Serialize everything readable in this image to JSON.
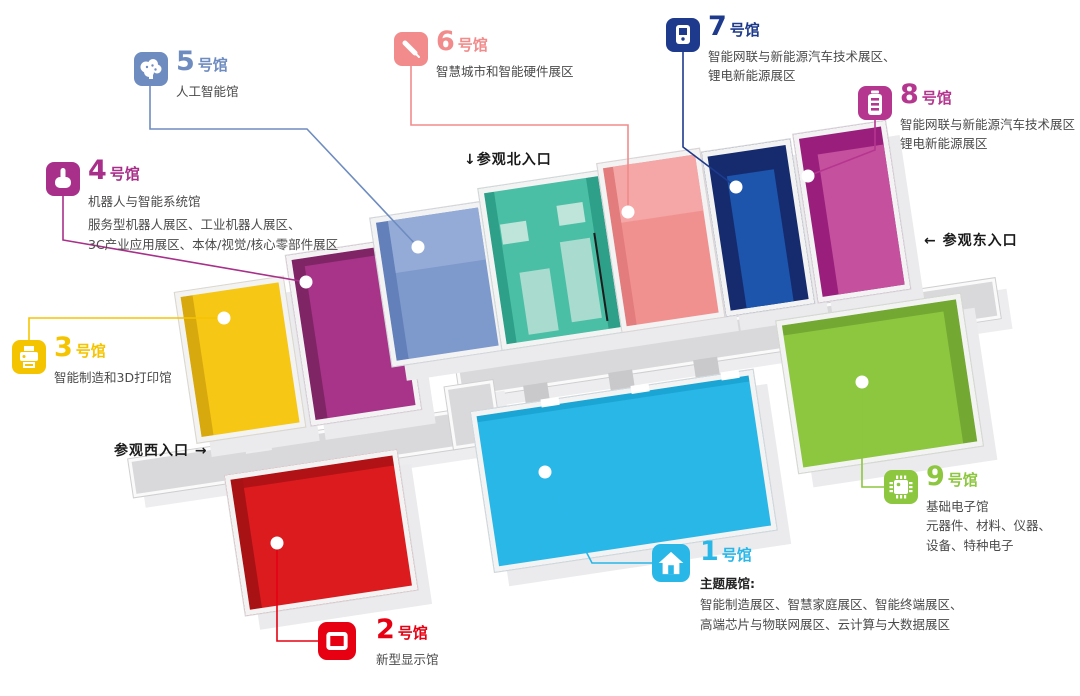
{
  "entrances": {
    "north": "↓参观北入口",
    "east": "← 参观东入口",
    "west": "参观西入口 →"
  },
  "halls": {
    "h1": {
      "num": "1",
      "suffix": "号馆",
      "bold": "主题展馆:",
      "desc1": "智能制造展区、智慧家庭展区、智能终端展区、",
      "desc2": "高端芯片与物联网展区、云计算与大数据展区",
      "color": "#29B7E8",
      "floor": "#29B7E8",
      "dark": "#1BA5D4",
      "icon": "home-icon"
    },
    "h2": {
      "num": "2",
      "suffix": "号馆",
      "desc1": "新型显示馆",
      "color": "#E60012",
      "floor": "#DC1B1E",
      "dark": "#A81215",
      "icon": "display-icon"
    },
    "h3": {
      "num": "3",
      "suffix": "号馆",
      "desc1": "智能制造和3D打印馆",
      "color": "#F5C400",
      "floor": "#F6C714",
      "dark": "#D8A90E",
      "icon": "printer-icon"
    },
    "h4": {
      "num": "4",
      "suffix": "号馆",
      "title": "机器人与智能系统馆",
      "desc1": "服务型机器人展区、工业机器人展区、",
      "desc2": "3C产业应用展区、本体/视觉/核心零部件展区",
      "color": "#A8308A",
      "floor": "#A73489",
      "dark": "#7F2566",
      "icon": "hand-icon"
    },
    "h5": {
      "num": "5",
      "suffix": "号馆",
      "desc1": "人工智能馆",
      "color": "#6E8CC0",
      "floor": "#7E99CC",
      "dark": "#6380BA",
      "light": "#93ABD6",
      "icon": "brain-icon"
    },
    "h6": {
      "num": "6",
      "suffix": "号馆",
      "desc1": "智慧城市和智能硬件展区",
      "color": "#F28B8B",
      "floor": "#F1918F",
      "dark": "#E27C7D",
      "light": "#F4A7A6",
      "icon": "pen-icon"
    },
    "h7": {
      "num": "7",
      "suffix": "号馆",
      "desc1": "智能网联与新能源汽车技术展区、",
      "desc2": "锂电新能源展区",
      "color": "#1E3A8C",
      "floor": "#1C55AB",
      "dark": "#152B6E",
      "icon": "charger-icon"
    },
    "h8": {
      "num": "8",
      "suffix": "号馆",
      "desc1": "智能网联与新能源汽车技术展区",
      "desc2": "锂电新能源展区",
      "color": "#B5368F",
      "floor": "#C5509E",
      "dark": "#9A1F7D",
      "icon": "battery-icon"
    },
    "h9": {
      "num": "9",
      "suffix": "号馆",
      "desc1": "基础电子馆",
      "desc2": "元器件、材料、仪器、",
      "desc3": "设备、特种电子",
      "color": "#8DC63F",
      "floor": "#8DC63F",
      "dark": "#73A833",
      "icon": "chip-icon"
    }
  },
  "map_colors": {
    "corridor": "#D9D9DB",
    "stub": "#C9C9CB",
    "base_shadow": "#EBEBED",
    "entrance_hall_floor": "#4ABFA5",
    "entrance_hall_dark": "#2E9F88",
    "booth_light": "#BFE4D9",
    "booth_mid": "#A9DCCF",
    "divider_line": "#1C1C1C",
    "dot": "#FFFFFF"
  }
}
